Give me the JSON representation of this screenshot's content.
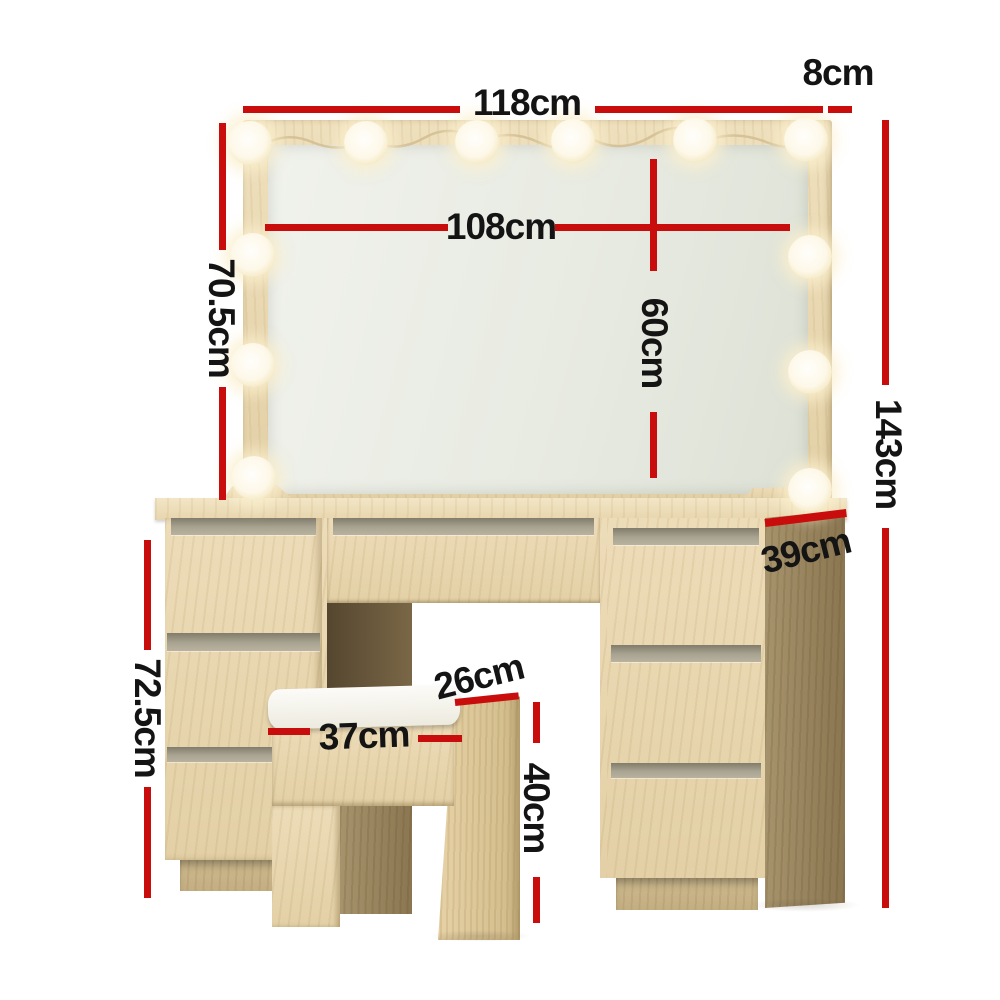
{
  "diagram": {
    "kind": "product-dimension-diagram",
    "product": "dressing table with hollywood mirror, drawers and stool",
    "bulb_count": 12
  },
  "colors": {
    "dimension_red": "#c90d0d",
    "label_text": "#141414",
    "wood_light": "#e9d8b4",
    "wood_dark": "#8a7650",
    "mirror_glass": "#e8ebe2",
    "cushion_white": "#f7f6f2",
    "background": "#ffffff"
  },
  "dimensions": {
    "overall_width": {
      "label": "118cm"
    },
    "frame_depth": {
      "label": "8cm"
    },
    "mirror_width": {
      "label": "108cm"
    },
    "mirror_height": {
      "label": "70.5cm"
    },
    "mirror_inner_height": {
      "label": "60cm"
    },
    "overall_height": {
      "label": "143cm"
    },
    "desk_depth": {
      "label": "39cm"
    },
    "desk_height": {
      "label": "72.5cm"
    },
    "stool_width": {
      "label": "37cm"
    },
    "stool_depth": {
      "label": "26cm"
    },
    "stool_height": {
      "label": "40cm"
    }
  }
}
